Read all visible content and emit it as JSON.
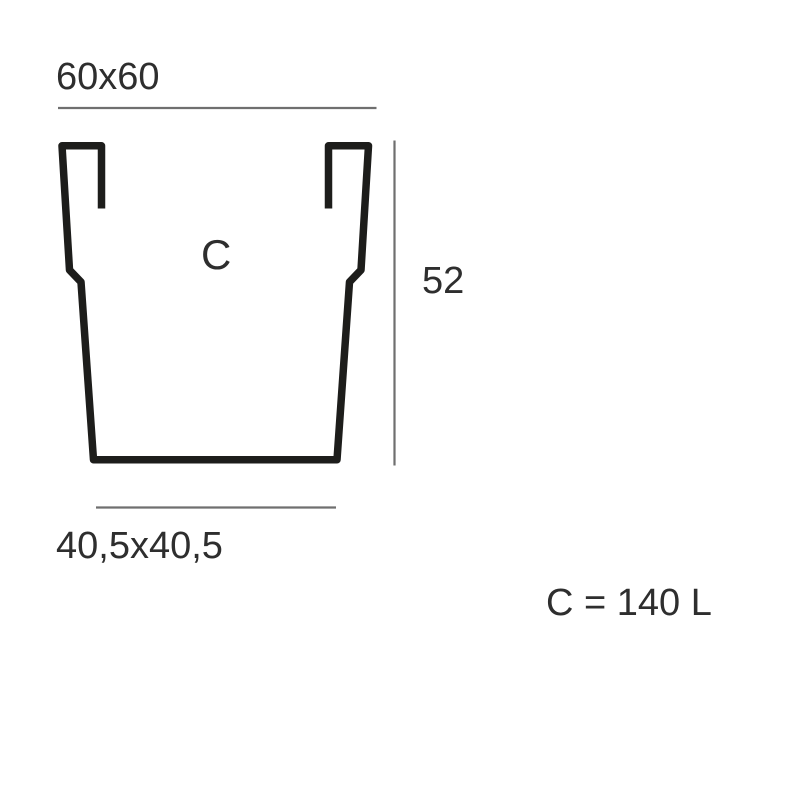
{
  "diagram": {
    "title_implied": "planter cross-section dimension drawing",
    "labels": {
      "top_width": "60x60",
      "height": "52",
      "capacity_letter": "C",
      "bottom_width": "40,5x40,5",
      "capacity": "C = 140 L"
    },
    "dimensions": {
      "top": "60x60",
      "height": "52",
      "bottom": "40,5x40,5",
      "capacity_liters": "140"
    },
    "colors": {
      "background": "#ffffff",
      "outline_stroke": "#1d1d1b",
      "dimension_line": "#6f6f6f",
      "text": "#2e2e2e"
    }
  }
}
